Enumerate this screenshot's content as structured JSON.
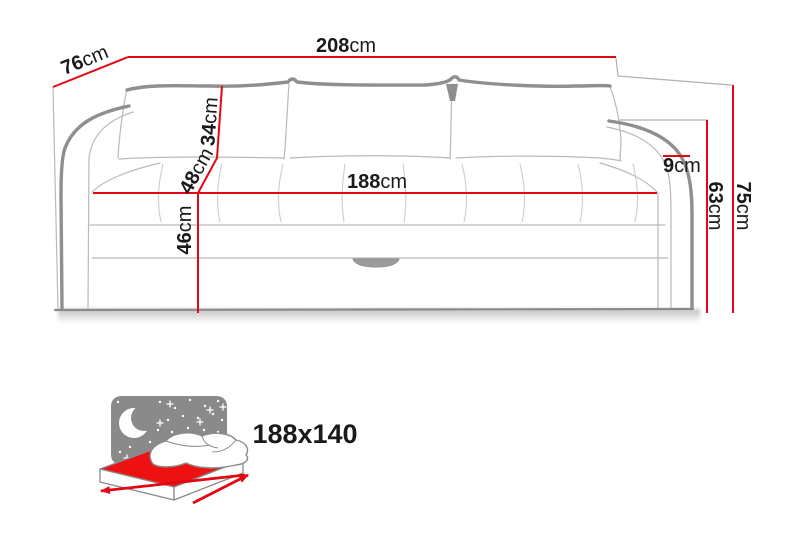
{
  "sofa": {
    "dimensions": [
      {
        "id": "depth",
        "value": "76",
        "unit": "cm"
      },
      {
        "id": "total_width",
        "value": "208",
        "unit": "cm"
      },
      {
        "id": "back_pillow_height",
        "value": "34",
        "unit": "cm"
      },
      {
        "id": "backrest_height",
        "value": "48",
        "unit": "cm"
      },
      {
        "id": "seat_height",
        "value": "46",
        "unit": "cm"
      },
      {
        "id": "seat_width",
        "value": "188",
        "unit": "cm"
      },
      {
        "id": "armrest_top_width",
        "value": "9",
        "unit": "cm"
      },
      {
        "id": "armrest_height",
        "value": "63",
        "unit": "cm"
      },
      {
        "id": "total_height",
        "value": "75",
        "unit": "cm"
      }
    ],
    "sleeping_area": {
      "size_label": "188x140"
    },
    "colors": {
      "dimension_line": "#e30613",
      "mattress_red": "#ee1111",
      "sky_gray": "#8a8a8a",
      "outline_gray": "#8f8f8f",
      "text": "#1a1a1a"
    }
  }
}
